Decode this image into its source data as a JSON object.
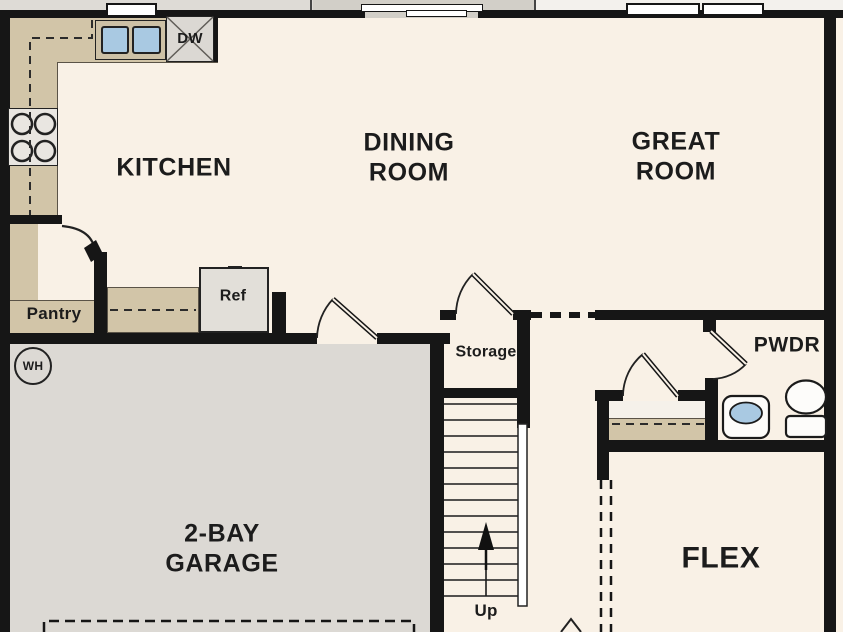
{
  "plan_title": "First floor plan",
  "labels": {
    "kitchen": "KITCHEN",
    "dining_line1": "DINING",
    "dining_line2": "ROOM",
    "great_line1": "GREAT",
    "great_line2": "ROOM",
    "garage_line1": "2-BAY",
    "garage_line2": "GARAGE",
    "flex": "FLEX",
    "pwdr": "PWDR",
    "pantry": "Pantry",
    "storage": "Storage",
    "ref": "Ref",
    "dw": "DW",
    "wh": "WH",
    "up": "Up"
  },
  "colors": {
    "floor_cream": "#f9f1e6",
    "garage_gray": "#dcd9d4",
    "counter_tan": "#d2c5a8",
    "wall_black": "#161616",
    "fixture_blue": "#a9c9e2",
    "exterior_gray": "#d2cfc8"
  }
}
